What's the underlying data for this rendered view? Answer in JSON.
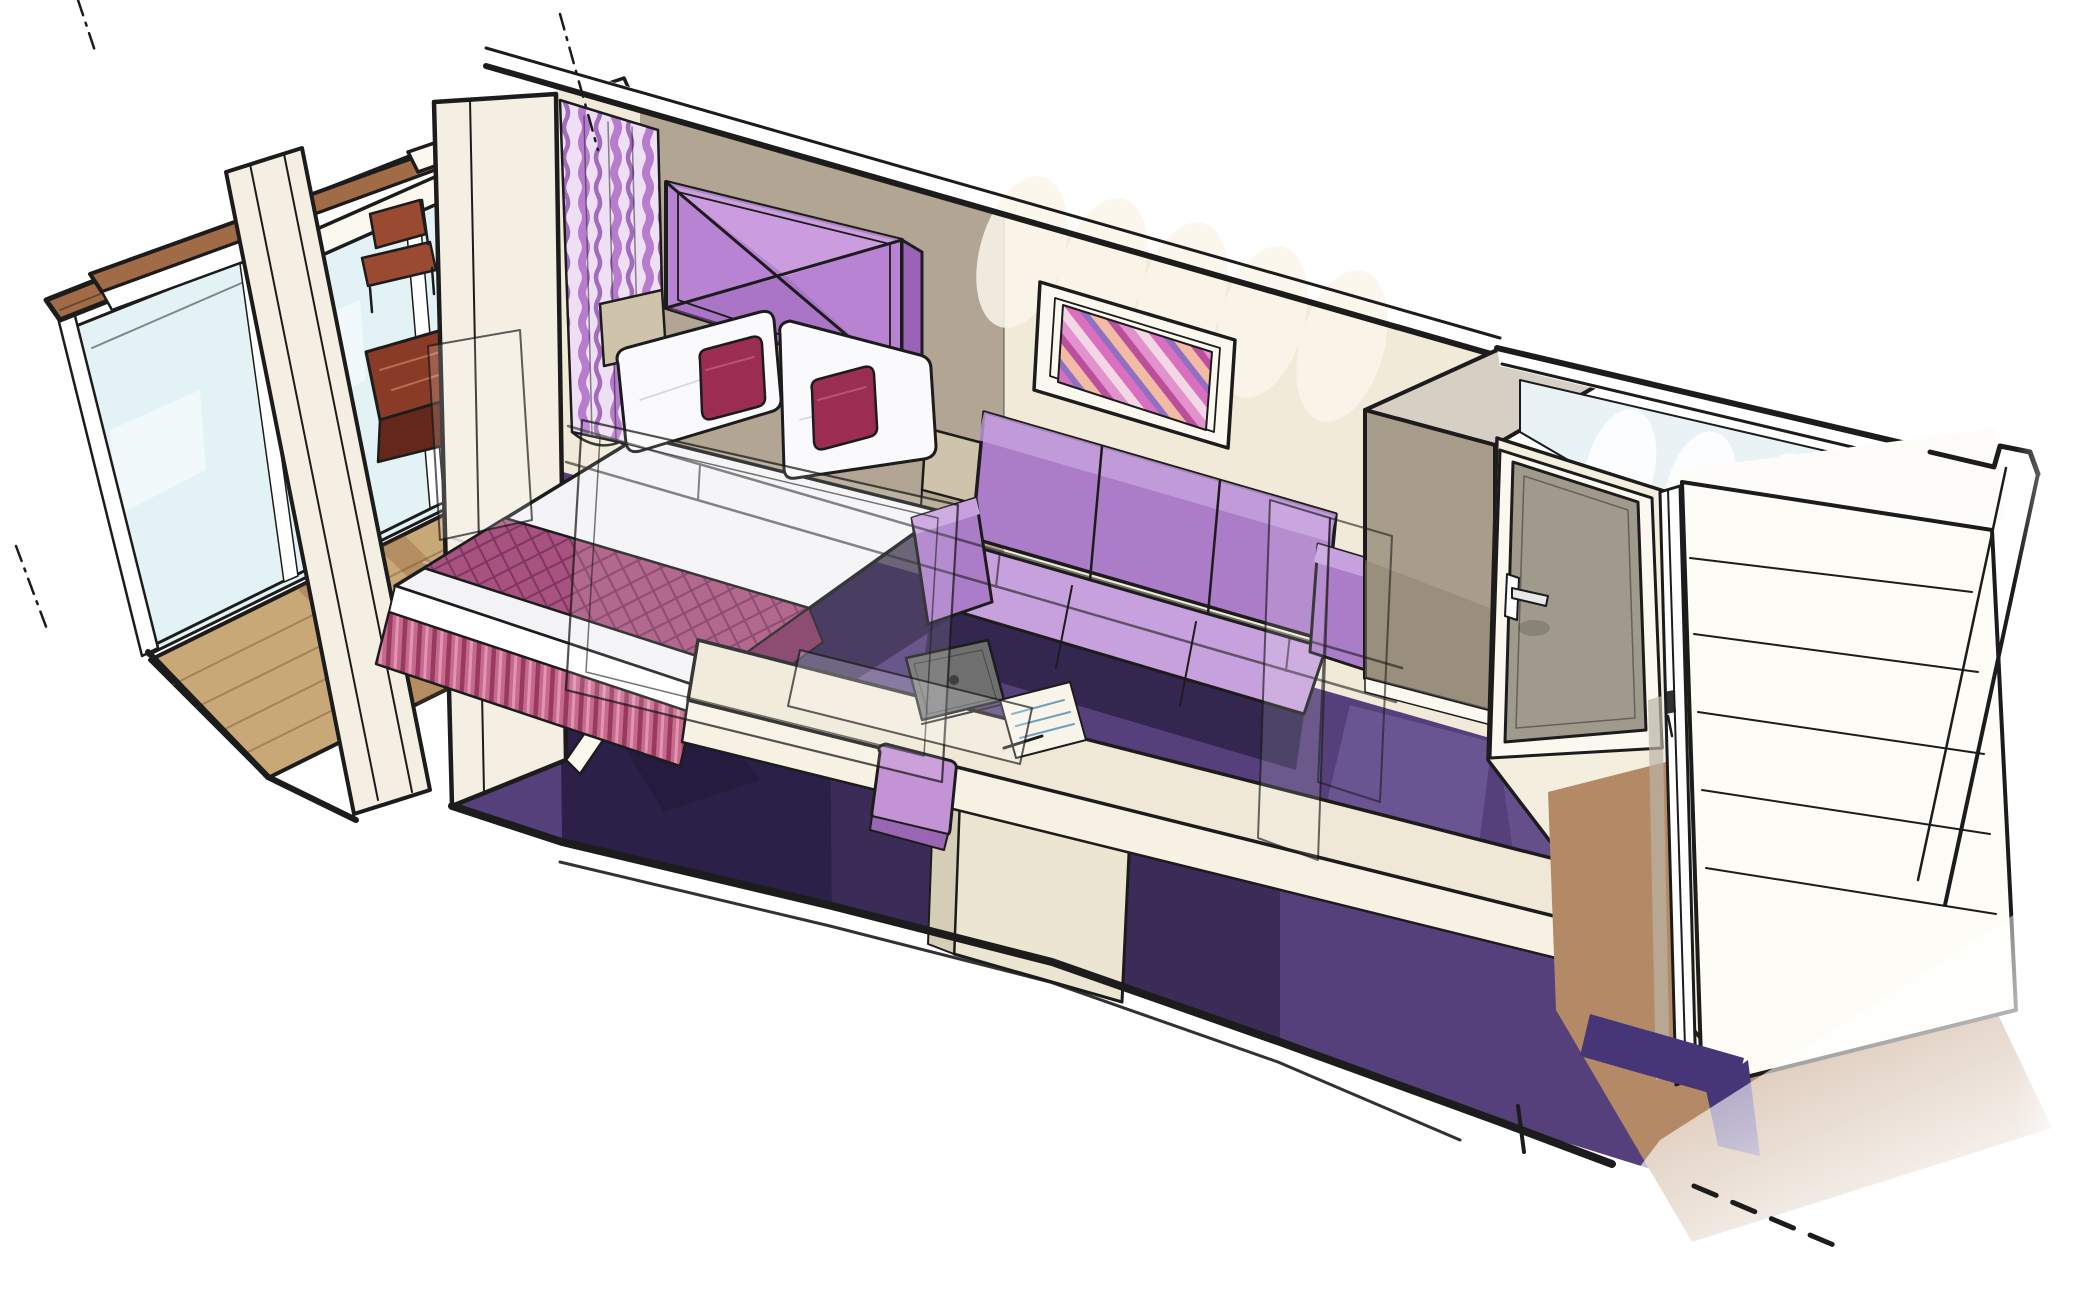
{
  "illustration": {
    "kind": "hand-drawn marker cutaway rendering",
    "subject": "cruise-ship balcony cabin (stateroom) seen in cutaway perspective",
    "areas": [
      "balcony",
      "bedroom",
      "sitting-area",
      "vanity-counter",
      "wardrobe",
      "bathroom",
      "entrance-hall"
    ],
    "objects": [
      "balcony-railing-with-glass-panels",
      "balcony-wood-deck",
      "round-balcony-table",
      "two-wood-chairs",
      "sliding-glass-door",
      "patterned-curtain",
      "upholstered-headboard",
      "double-bed-with-runner-and-pleated-skirt",
      "accent-cushions",
      "nightstands",
      "purple-carpet",
      "three-seat-sofa",
      "diagonal-stripe-artwork",
      "long-vanity-counter",
      "tablet-and-papers",
      "stool",
      "wardrobe-unit",
      "bathroom-door-with-lever-handle",
      "bathroom-walls-top-view",
      "open-entrance-door",
      "entrance-tan-floor",
      "l-shaped-purple-mat",
      "ghost-partition-outlines",
      "section-leader-lines"
    ]
  },
  "colors": {
    "ink": "#1c1c1c",
    "paper": "#ffffff",
    "white": "#ffffff",
    "cream": "#f4efe2",
    "creamBright": "#fbf8f0",
    "glass": "#d9edf2",
    "woodCap": "#a06b46",
    "deckWood": "#c9a878",
    "deckShadow": "#7c4a28",
    "plankLine": "#8a6a44",
    "tableWood": "#8a3b28",
    "tableWoodDark": "#63281a",
    "tableHighlight": "#c27a5a",
    "chairWood": "#9a4a30",
    "wallCream": "#f2ead8",
    "taupeWall": "#b3a593",
    "scallop": "#fbf6ea",
    "curtainBase": "#eedff4",
    "curtainStripeA": "#b577cd",
    "curtainStripeB": "#8f4fb0",
    "hbLight": "#d0a4e2",
    "hbMid": "#b983d3",
    "hbDark": "#9a63b8",
    "pillow": "#fafafc",
    "pillowShade": "#b9b9c9",
    "cushion": "#9c2d52",
    "cushionLight": "#c05a7c",
    "duvet": "#f3f3f6",
    "duvetShade": "#c6c6d4",
    "runner": "#a8537f",
    "runnerDark": "#7e3560",
    "skirt": "#c7688d",
    "skirtDark": "#8f3158",
    "skirtLight": "#e39ab4",
    "carpet": "#55407b",
    "carpetLight": "#7a66a6",
    "carpetDark": "#34264f",
    "carpetDeep": "#241b3e",
    "nightstand": "#cfc3ac",
    "nightstandDark": "#b2a68e",
    "sofaLight": "#c7a1dd",
    "sofaMid": "#ab7cc8",
    "sofaShadow": "#2a2046",
    "counterTop": "#efe8d6",
    "counterFace": "#f6f1e3",
    "cabinetFace": "#ece5d2",
    "cabinetSide": "#d6cdb6",
    "stool": "#c493d6",
    "stoolDark": "#9a66b4",
    "tablet": "#6f6f6f",
    "tabletDark": "#3f3f3f",
    "paperSheet": "#f8f4ea",
    "paperLine": "#6fa0bd",
    "wardrobeTop": "#d6d0c4",
    "wardrobeFront": "#a89c8b",
    "wardrobeFrontDark": "#8b8070",
    "bathDoor": "#a09a8c",
    "bathFrame": "#fbf8ef",
    "bathWallFace": "#f4eedf",
    "bathInterior": "#e9f3f6",
    "doorEdgeShade": "#b9b3a6",
    "handleChrome": "#e8e8e8",
    "hallWall": "#fdfcf8",
    "entranceDoor": "#fdfcf7",
    "tanFloor": "#b48a66",
    "mat": "#463577",
    "artPink": "#d96fbe",
    "artPurple": "#9070c2",
    "artPeach": "#f2bca4",
    "artMagenta": "#bb4f9e",
    "artPink2": "#e292cc",
    "artPale": "#f3d7e5"
  }
}
